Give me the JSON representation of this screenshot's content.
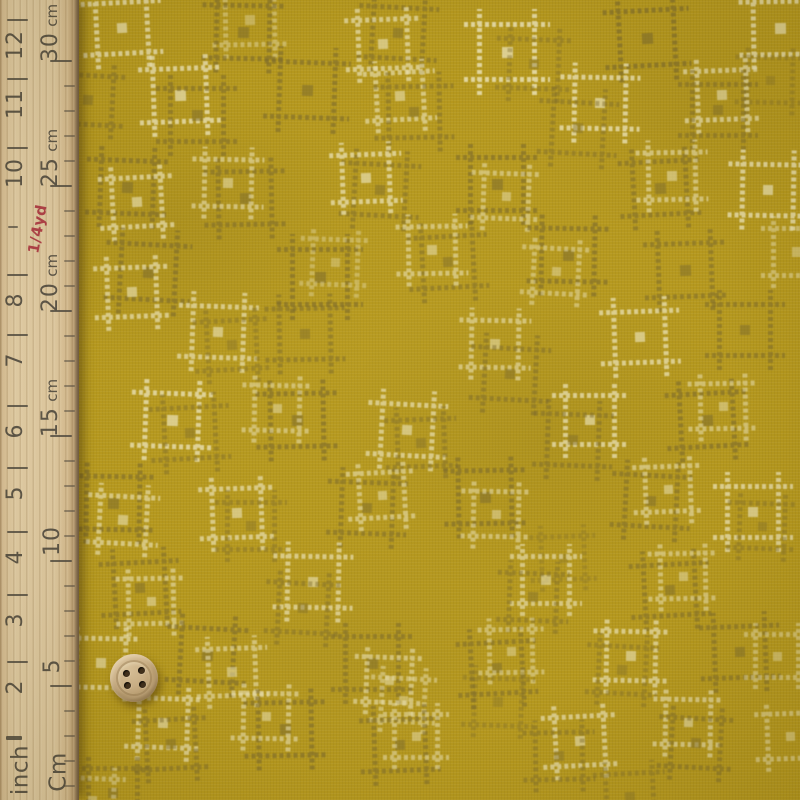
{
  "scene": {
    "description": "Mustard yellow quilting fabric with scattered cream and olive square kasuri motifs, wooden ruler along left edge, small wooden four-hole button for scale"
  },
  "ruler": {
    "text_color": "#4b463c",
    "red_color": "#a92f3c",
    "inch_marks": [
      {
        "label": "12",
        "tick_y": 19
      },
      {
        "label": "11",
        "tick_y": 78
      },
      {
        "label": "10",
        "tick_y": 147
      },
      {
        "label": "1/4yd",
        "tick_y": 226,
        "style": "red"
      },
      {
        "label": "8",
        "tick_y": 274
      },
      {
        "label": "7",
        "tick_y": 334
      },
      {
        "label": "6",
        "tick_y": 405
      },
      {
        "label": "5",
        "tick_y": 467
      },
      {
        "label": "4",
        "tick_y": 531
      },
      {
        "label": "3",
        "tick_y": 594
      },
      {
        "label": "2",
        "tick_y": 661
      },
      {
        "label": "inch",
        "tick_y": 736,
        "style": "unit"
      }
    ],
    "cm_marks": [
      {
        "label": "30",
        "suffix": "cm",
        "tick_y": 60
      },
      {
        "label": "25",
        "suffix": "cm",
        "tick_y": 185
      },
      {
        "label": "20",
        "suffix": "cm",
        "tick_y": 310
      },
      {
        "label": "15",
        "suffix": "cm",
        "tick_y": 435
      },
      {
        "label": "10",
        "suffix": "",
        "tick_y": 560
      },
      {
        "label": "5",
        "suffix": "",
        "tick_y": 685
      },
      {
        "label": "Cm",
        "suffix": "",
        "tick_y": 772,
        "style": "unit"
      }
    ],
    "cm_minor_ticks": {
      "start_y": 60,
      "spacing": 25,
      "count": 30
    }
  },
  "fabric": {
    "base_color": "#b5981e",
    "cream_color": "#e9e0b2",
    "dark_color": "#7d6b2c",
    "motifs": [
      {
        "x": 122,
        "y": 28,
        "s": 52,
        "c": "cream",
        "o": 0.8
      },
      {
        "x": 250,
        "y": 20,
        "s": 50,
        "c": "cream",
        "o": 0.45
      },
      {
        "x": 243,
        "y": 32,
        "s": 54,
        "c": "dark",
        "o": 0.6
      },
      {
        "x": 398,
        "y": 33,
        "s": 52,
        "c": "dark",
        "o": 0.55
      },
      {
        "x": 383,
        "y": 44,
        "s": 50,
        "c": "cream",
        "o": 0.7
      },
      {
        "x": 507,
        "y": 52,
        "s": 56,
        "c": "cream",
        "o": 0.85
      },
      {
        "x": 534,
        "y": 64,
        "s": 50,
        "c": "dark",
        "o": 0.4
      },
      {
        "x": 647,
        "y": 38,
        "s": 56,
        "c": "dark",
        "o": 0.65
      },
      {
        "x": 780,
        "y": 28,
        "s": 54,
        "c": "cream",
        "o": 0.8
      },
      {
        "x": 770,
        "y": 80,
        "s": 46,
        "c": "dark",
        "o": 0.35
      },
      {
        "x": 88,
        "y": 100,
        "s": 50,
        "c": "dark",
        "o": 0.5
      },
      {
        "x": 180,
        "y": 95,
        "s": 54,
        "c": "cream",
        "o": 0.8
      },
      {
        "x": 197,
        "y": 115,
        "s": 54,
        "c": "dark",
        "o": 0.55
      },
      {
        "x": 307,
        "y": 90,
        "s": 56,
        "c": "dark",
        "o": 0.6
      },
      {
        "x": 400,
        "y": 96,
        "s": 48,
        "c": "cream",
        "o": 0.65
      },
      {
        "x": 414,
        "y": 112,
        "s": 52,
        "c": "dark",
        "o": 0.5
      },
      {
        "x": 600,
        "y": 103,
        "s": 52,
        "c": "cream",
        "o": 0.8
      },
      {
        "x": 578,
        "y": 128,
        "s": 52,
        "c": "dark",
        "o": 0.45
      },
      {
        "x": 722,
        "y": 95,
        "s": 50,
        "c": "cream",
        "o": 0.7
      },
      {
        "x": 718,
        "y": 110,
        "s": 52,
        "c": "dark",
        "o": 0.5
      },
      {
        "x": 127,
        "y": 187,
        "s": 54,
        "c": "dark",
        "o": 0.6
      },
      {
        "x": 137,
        "y": 202,
        "s": 50,
        "c": "cream",
        "o": 0.7
      },
      {
        "x": 245,
        "y": 198,
        "s": 54,
        "c": "dark",
        "o": 0.55
      },
      {
        "x": 228,
        "y": 183,
        "s": 48,
        "c": "cream",
        "o": 0.6
      },
      {
        "x": 380,
        "y": 190,
        "s": 52,
        "c": "dark",
        "o": 0.5
      },
      {
        "x": 366,
        "y": 178,
        "s": 48,
        "c": "cream",
        "o": 0.75
      },
      {
        "x": 497,
        "y": 184,
        "s": 54,
        "c": "dark",
        "o": 0.6
      },
      {
        "x": 506,
        "y": 196,
        "s": 46,
        "c": "cream",
        "o": 0.55
      },
      {
        "x": 660,
        "y": 188,
        "s": 54,
        "c": "dark",
        "o": 0.55
      },
      {
        "x": 672,
        "y": 176,
        "s": 48,
        "c": "cream",
        "o": 0.6
      },
      {
        "x": 768,
        "y": 190,
        "s": 52,
        "c": "cream",
        "o": 0.8
      },
      {
        "x": 148,
        "y": 272,
        "s": 56,
        "c": "dark",
        "o": 0.6
      },
      {
        "x": 132,
        "y": 292,
        "s": 50,
        "c": "cream",
        "o": 0.7
      },
      {
        "x": 320,
        "y": 277,
        "s": 56,
        "c": "dark",
        "o": 0.6
      },
      {
        "x": 335,
        "y": 262,
        "s": 46,
        "c": "cream",
        "o": 0.4
      },
      {
        "x": 448,
        "y": 262,
        "s": 52,
        "c": "dark",
        "o": 0.5
      },
      {
        "x": 432,
        "y": 250,
        "s": 48,
        "c": "cream",
        "o": 0.6
      },
      {
        "x": 568,
        "y": 255,
        "s": 54,
        "c": "dark",
        "o": 0.6
      },
      {
        "x": 556,
        "y": 271,
        "s": 46,
        "c": "cream",
        "o": 0.5
      },
      {
        "x": 685,
        "y": 270,
        "s": 54,
        "c": "dark",
        "o": 0.55
      },
      {
        "x": 797,
        "y": 252,
        "s": 48,
        "c": "cream",
        "o": 0.5
      },
      {
        "x": 218,
        "y": 332,
        "s": 52,
        "c": "cream",
        "o": 0.7
      },
      {
        "x": 232,
        "y": 345,
        "s": 50,
        "c": "dark",
        "o": 0.4
      },
      {
        "x": 305,
        "y": 334,
        "s": 52,
        "c": "dark",
        "o": 0.5
      },
      {
        "x": 495,
        "y": 344,
        "s": 48,
        "c": "cream",
        "o": 0.6
      },
      {
        "x": 510,
        "y": 374,
        "s": 52,
        "c": "dark",
        "o": 0.5
      },
      {
        "x": 640,
        "y": 337,
        "s": 52,
        "c": "cream",
        "o": 0.75
      },
      {
        "x": 745,
        "y": 330,
        "s": 52,
        "c": "dark",
        "o": 0.55
      },
      {
        "x": 172,
        "y": 420,
        "s": 54,
        "c": "cream",
        "o": 0.8
      },
      {
        "x": 190,
        "y": 433,
        "s": 52,
        "c": "dark",
        "o": 0.45
      },
      {
        "x": 297,
        "y": 420,
        "s": 54,
        "c": "dark",
        "o": 0.6
      },
      {
        "x": 277,
        "y": 408,
        "s": 46,
        "c": "cream",
        "o": 0.55
      },
      {
        "x": 407,
        "y": 430,
        "s": 52,
        "c": "cream",
        "o": 0.7
      },
      {
        "x": 421,
        "y": 443,
        "s": 48,
        "c": "dark",
        "o": 0.45
      },
      {
        "x": 590,
        "y": 420,
        "s": 50,
        "c": "cream",
        "o": 0.75
      },
      {
        "x": 573,
        "y": 440,
        "s": 52,
        "c": "dark",
        "o": 0.5
      },
      {
        "x": 707,
        "y": 420,
        "s": 54,
        "c": "dark",
        "o": 0.6
      },
      {
        "x": 723,
        "y": 406,
        "s": 46,
        "c": "cream",
        "o": 0.55
      },
      {
        "x": 113,
        "y": 503,
        "s": 54,
        "c": "dark",
        "o": 0.6
      },
      {
        "x": 123,
        "y": 520,
        "s": 48,
        "c": "cream",
        "o": 0.65
      },
      {
        "x": 237,
        "y": 513,
        "s": 50,
        "c": "cream",
        "o": 0.7
      },
      {
        "x": 251,
        "y": 526,
        "s": 48,
        "c": "dark",
        "o": 0.4
      },
      {
        "x": 367,
        "y": 508,
        "s": 52,
        "c": "dark",
        "o": 0.55
      },
      {
        "x": 382,
        "y": 495,
        "s": 46,
        "c": "cream",
        "o": 0.6
      },
      {
        "x": 485,
        "y": 497,
        "s": 54,
        "c": "dark",
        "o": 0.6
      },
      {
        "x": 496,
        "y": 514,
        "s": 46,
        "c": "cream",
        "o": 0.55
      },
      {
        "x": 651,
        "y": 501,
        "s": 52,
        "c": "dark",
        "o": 0.55
      },
      {
        "x": 668,
        "y": 489,
        "s": 46,
        "c": "cream",
        "o": 0.6
      },
      {
        "x": 753,
        "y": 512,
        "s": 52,
        "c": "cream",
        "o": 0.75
      },
      {
        "x": 762,
        "y": 526,
        "s": 46,
        "c": "dark",
        "o": 0.4
      },
      {
        "x": 140,
        "y": 588,
        "s": 52,
        "c": "dark",
        "o": 0.55
      },
      {
        "x": 151,
        "y": 601,
        "s": 46,
        "c": "cream",
        "o": 0.6
      },
      {
        "x": 313,
        "y": 582,
        "s": 52,
        "c": "cream",
        "o": 0.7
      },
      {
        "x": 303,
        "y": 608,
        "s": 50,
        "c": "dark",
        "o": 0.45
      },
      {
        "x": 563,
        "y": 558,
        "s": 44,
        "c": "dark",
        "o": 0.3
      },
      {
        "x": 546,
        "y": 580,
        "s": 48,
        "c": "cream",
        "o": 0.65
      },
      {
        "x": 533,
        "y": 597,
        "s": 48,
        "c": "dark",
        "o": 0.45
      },
      {
        "x": 670,
        "y": 590,
        "s": 52,
        "c": "dark",
        "o": 0.55
      },
      {
        "x": 683,
        "y": 576,
        "s": 46,
        "c": "cream",
        "o": 0.55
      },
      {
        "x": 101,
        "y": 663,
        "s": 50,
        "c": "cream",
        "o": 0.7
      },
      {
        "x": 207,
        "y": 655,
        "s": 54,
        "c": "dark",
        "o": 0.6
      },
      {
        "x": 232,
        "y": 672,
        "s": 48,
        "c": "cream",
        "o": 0.6
      },
      {
        "x": 372,
        "y": 663,
        "s": 54,
        "c": "dark",
        "o": 0.55
      },
      {
        "x": 389,
        "y": 680,
        "s": 46,
        "c": "cream",
        "o": 0.6
      },
      {
        "x": 497,
        "y": 668,
        "s": 52,
        "c": "dark",
        "o": 0.55
      },
      {
        "x": 511,
        "y": 651,
        "s": 44,
        "c": "cream",
        "o": 0.5
      },
      {
        "x": 631,
        "y": 656,
        "s": 50,
        "c": "cream",
        "o": 0.7
      },
      {
        "x": 622,
        "y": 670,
        "s": 48,
        "c": "dark",
        "o": 0.4
      },
      {
        "x": 740,
        "y": 652,
        "s": 52,
        "c": "dark",
        "o": 0.55
      },
      {
        "x": 777,
        "y": 656,
        "s": 44,
        "c": "cream",
        "o": 0.5
      },
      {
        "x": 163,
        "y": 723,
        "s": 50,
        "c": "cream",
        "o": 0.7
      },
      {
        "x": 171,
        "y": 744,
        "s": 50,
        "c": "dark",
        "o": 0.5
      },
      {
        "x": 285,
        "y": 729,
        "s": 54,
        "c": "dark",
        "o": 0.6
      },
      {
        "x": 266,
        "y": 716,
        "s": 46,
        "c": "cream",
        "o": 0.6
      },
      {
        "x": 403,
        "y": 700,
        "s": 44,
        "c": "cream",
        "o": 0.5
      },
      {
        "x": 400,
        "y": 745,
        "s": 52,
        "c": "dark",
        "o": 0.55
      },
      {
        "x": 416,
        "y": 736,
        "s": 44,
        "c": "cream",
        "o": 0.55
      },
      {
        "x": 498,
        "y": 702,
        "s": 48,
        "c": "dark",
        "o": 0.35
      },
      {
        "x": 580,
        "y": 741,
        "s": 50,
        "c": "cream",
        "o": 0.7
      },
      {
        "x": 559,
        "y": 756,
        "s": 48,
        "c": "dark",
        "o": 0.45
      },
      {
        "x": 688,
        "y": 722,
        "s": 46,
        "c": "cream",
        "o": 0.65
      },
      {
        "x": 696,
        "y": 743,
        "s": 50,
        "c": "dark",
        "o": 0.5
      },
      {
        "x": 790,
        "y": 736,
        "s": 46,
        "c": "cream",
        "o": 0.55
      },
      {
        "x": 113,
        "y": 793,
        "s": 50,
        "c": "dark",
        "o": 0.5
      },
      {
        "x": 92,
        "y": 800,
        "s": 44,
        "c": "cream",
        "o": 0.5
      },
      {
        "x": 630,
        "y": 797,
        "s": 48,
        "c": "dark",
        "o": 0.4
      }
    ]
  },
  "button": {
    "cx": 134,
    "cy": 678,
    "r": 24,
    "face_color": "#cdb289",
    "hole_color": "#41301d",
    "holes": [
      [
        -8,
        -5
      ],
      [
        7,
        -8
      ],
      [
        -7,
        7
      ],
      [
        8,
        6
      ]
    ]
  }
}
